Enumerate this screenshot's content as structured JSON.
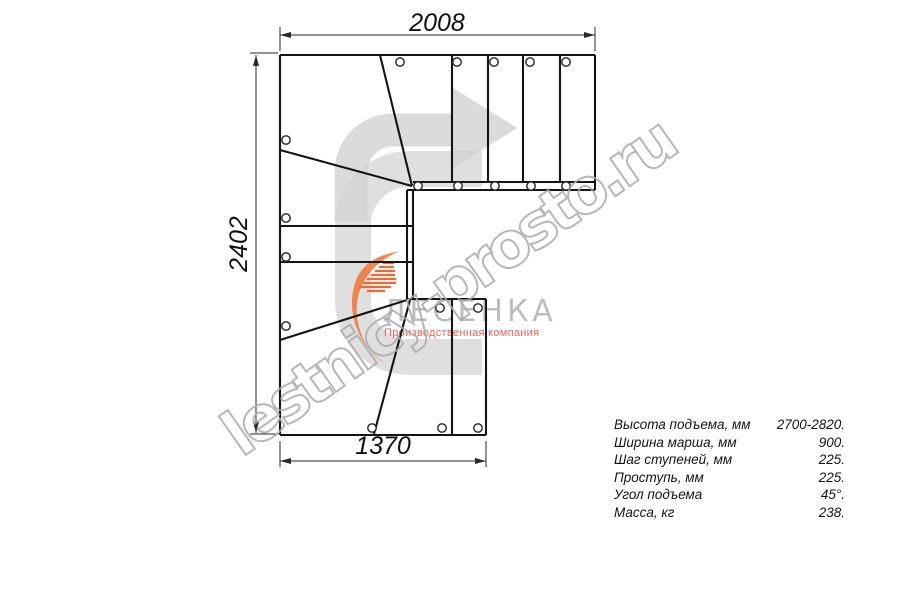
{
  "page": {
    "background": "#ffffff"
  },
  "watermark": {
    "text": "lestnicy-prosto.ru",
    "color": "#ababab"
  },
  "logo": {
    "name": "ЛЕСЕНКА",
    "subtitle": "Производственная компания",
    "name_color": "#bdbdbd",
    "subtitle_color": "#e2685d",
    "mark_color": "#d7d7d7",
    "flame_color": "#ee7a43",
    "flame_dash_color": "#ea6b38"
  },
  "arrow": {
    "color": "#d2d2d2"
  },
  "dimensions": [
    {
      "label": "2008",
      "line": [
        280,
        35,
        595,
        35
      ],
      "ext": [
        [
          280,
          27,
          280,
          51
        ],
        [
          595,
          27,
          595,
          51
        ]
      ],
      "arrows": [
        [
          280,
          35,
          0
        ],
        [
          595,
          35,
          180
        ]
      ],
      "text": [
        437,
        31
      ],
      "trot": 0
    },
    {
      "label": "2402",
      "line": [
        256,
        55,
        256,
        433
      ],
      "ext": [
        [
          250,
          53,
          278,
          53
        ],
        [
          250,
          434,
          278,
          434
        ]
      ],
      "arrows": [
        [
          256,
          55,
          90
        ],
        [
          256,
          433,
          270
        ]
      ],
      "text": [
        247,
        244
      ],
      "trot": -90
    },
    {
      "label": "1370",
      "line": [
        280,
        461,
        486,
        461
      ],
      "ext": [
        [
          280,
          441,
          280,
          467
        ],
        [
          486,
          441,
          486,
          467
        ]
      ],
      "arrows": [
        [
          280,
          461,
          0
        ],
        [
          486,
          461,
          180
        ]
      ],
      "text": [
        383,
        454
      ],
      "trot": 0
    }
  ],
  "specs": {
    "rows": [
      {
        "label": "Высота подъема, мм",
        "value": "2700-2820."
      },
      {
        "label": "Ширина марша, мм",
        "value": "900."
      },
      {
        "label": "Шаг ступеней, мм",
        "value": "225."
      },
      {
        "label": "Проступь, мм",
        "value": "225."
      },
      {
        "label": "Угол подъема",
        "value": "45°."
      },
      {
        "label": "Масса, кг",
        "value": "238."
      }
    ]
  },
  "drawing": {
    "line_color": "#141414",
    "dim_color": "#2a2a2a",
    "hole_color": "#222222",
    "circle_radius": 4.2,
    "segments": [
      [
        280,
        55,
        595,
        55
      ],
      [
        280,
        55,
        280,
        435
      ],
      [
        595,
        55,
        595,
        190
      ],
      [
        280,
        435,
        486,
        435
      ],
      [
        486,
        299,
        486,
        435
      ],
      [
        407,
        299,
        486,
        299
      ],
      [
        413,
        182,
        595,
        182
      ],
      [
        407,
        190,
        595,
        190
      ],
      [
        452,
        55,
        452,
        182
      ],
      [
        488,
        55,
        488,
        182
      ],
      [
        523,
        55,
        523,
        182
      ],
      [
        560,
        55,
        560,
        182
      ],
      [
        380,
        55,
        412,
        186
      ],
      [
        280,
        150,
        412,
        186
      ],
      [
        407,
        190,
        407,
        299
      ],
      [
        413,
        190,
        413,
        299
      ],
      [
        280,
        226,
        413,
        226
      ],
      [
        280,
        262,
        413,
        262
      ],
      [
        280,
        340,
        407,
        300
      ],
      [
        410,
        300,
        374,
        434
      ],
      [
        452,
        299,
        452,
        435
      ]
    ],
    "circles": [
      [
        400,
        62
      ],
      [
        457,
        62
      ],
      [
        494,
        62
      ],
      [
        530,
        62
      ],
      [
        566,
        62
      ],
      [
        418,
        186
      ],
      [
        458,
        186
      ],
      [
        495,
        186
      ],
      [
        531,
        186
      ],
      [
        566,
        186
      ],
      [
        286,
        140
      ],
      [
        286,
        218
      ],
      [
        286,
        257
      ],
      [
        286,
        326
      ],
      [
        440,
        308
      ],
      [
        478,
        308
      ],
      [
        372,
        428
      ],
      [
        442,
        428
      ],
      [
        478,
        428
      ]
    ],
    "flame_dashes": [
      [
        383,
        263,
        394
      ],
      [
        379,
        267,
        394
      ],
      [
        375,
        271,
        395
      ],
      [
        371,
        275,
        395
      ],
      [
        367,
        279,
        396
      ],
      [
        363,
        283,
        396
      ],
      [
        359,
        287,
        391
      ],
      [
        367,
        291,
        385
      ]
    ]
  }
}
